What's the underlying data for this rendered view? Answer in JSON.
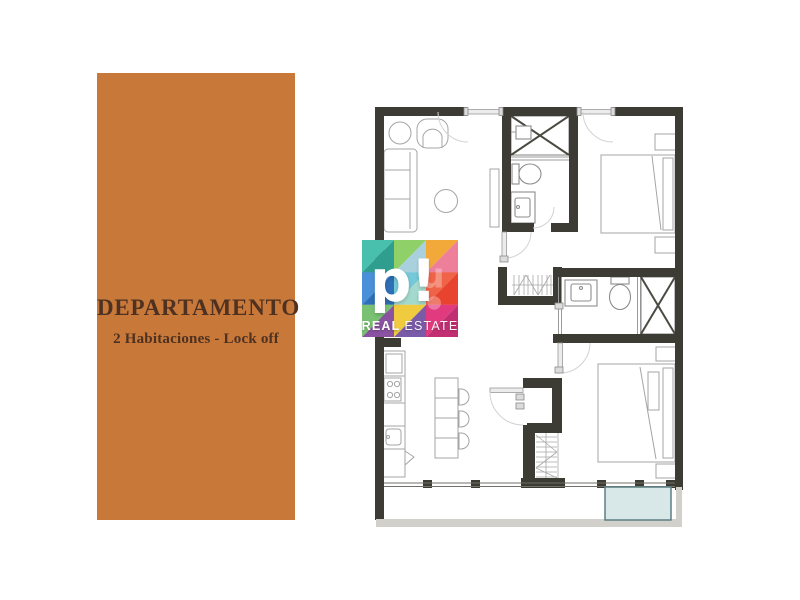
{
  "panel": {
    "title": "DEPARTAMENTO",
    "subtitle": "2 Habitaciones - Lock off",
    "bg_color": "#c8793a",
    "text_color": "#4e3120"
  },
  "watermark": {
    "monogram": "p!",
    "brand_bold": "REAL",
    "brand_light": "ESTATE",
    "ghost_glyph": "u",
    "mosaic_colors": [
      "#49bfae",
      "#2f9e8f",
      "#8fd168",
      "#a9d0dd",
      "#f2a93a",
      "#ee7f9a",
      "#4a90d9",
      "#2e6fb5",
      "#74c8d8",
      "#a4d9cd",
      "#ef6348",
      "#e8432f",
      "#7ac174",
      "#8a52a0",
      "#f0ca3f",
      "#7a5ba8",
      "#e23a7e",
      "#c22e72"
    ]
  },
  "floorplan": {
    "wall_color": "#3c3b34",
    "furniture_color": "#a4a4a4",
    "pool_fill": "#d8e7e8",
    "pool_border": "#5c7e84",
    "balcony_slab_color": "#d2d0ca",
    "fixtures": [
      "lounge-chair",
      "armchair",
      "sofa",
      "side-table",
      "wardrobe-cabinet",
      "shower",
      "toilet",
      "vanity-sink",
      "double-bed",
      "nightstands",
      "refrigerator",
      "stove",
      "kitchen-sink",
      "kitchen-island",
      "bar-stools",
      "hanging-closet",
      "linen-closet",
      "entry-doors",
      "sliding-windows",
      "plunge-pool"
    ]
  }
}
